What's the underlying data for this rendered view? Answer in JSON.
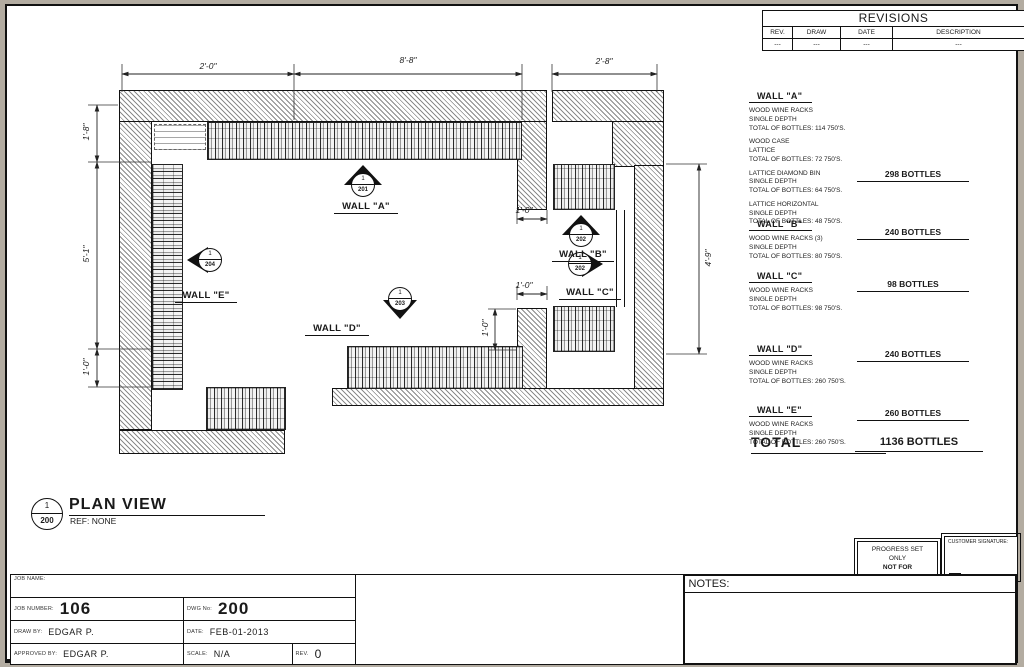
{
  "revisions": {
    "title": "REVISIONS",
    "columns": [
      "REV.",
      "DRAW",
      "DATE",
      "DESCRIPTION"
    ],
    "row": [
      "---",
      "---",
      "---",
      "---"
    ]
  },
  "plan": {
    "title": {
      "num": "1",
      "sheet": "200",
      "title": "PLAN VIEW",
      "ref": "REF: NONE"
    },
    "dims": {
      "top1": "2'-0\"",
      "top2": "8'-8\"",
      "top3": "2'-8\"",
      "left1": "1'-8\"",
      "left2": "5'-1\"",
      "left3": "1'-0\"",
      "right1": "4'-9\"",
      "inner_b": "1'-0\"",
      "inner_c": "1'-0\"",
      "inner_d": "1'-0\""
    },
    "markers": {
      "a": {
        "num": "1",
        "sheet": "201",
        "label": "WALL \"A\""
      },
      "b": {
        "num": "1",
        "sheet": "202",
        "label": "WALL \"B\""
      },
      "c": {
        "num": "1",
        "sheet": "202",
        "label": "WALL \"C\""
      },
      "d": {
        "num": "1",
        "sheet": "203",
        "label": "WALL \"D\""
      },
      "e": {
        "num": "1",
        "sheet": "204",
        "label": "WALL \"E\""
      }
    }
  },
  "specs": {
    "walls": [
      {
        "name": "WALL \"A\"",
        "items": [
          "WOOD WINE RACKS\nSINGLE DEPTH\nTOTAL OF BOTTLES: 114 750'S.",
          "WOOD CASE\nLATTICE\nTOTAL OF BOTTLES: 72 750'S.",
          "LATTICE DIAMOND BIN\nSINGLE DEPTH\nTOTAL OF BOTTLES: 64 750'S.",
          "LATTICE HORIZONTAL\nSINGLE DEPTH\nTOTAL OF BOTTLES: 48 750'S."
        ],
        "total": "298 BOTTLES"
      },
      {
        "name": "WALL \"B\"",
        "items": [
          "WOOD WINE RACKS (3)\nSINGLE DEPTH\nTOTAL OF BOTTLES: 80 750'S."
        ],
        "total": "240 BOTTLES"
      },
      {
        "name": "WALL \"C\"",
        "items": [
          "WOOD WINE RACKS\nSINGLE DEPTH\nTOTAL OF BOTTLES: 98 750'S."
        ],
        "total": "98 BOTTLES"
      },
      {
        "name": "WALL \"D\"",
        "items": [
          "WOOD WINE RACKS\nSINGLE DEPTH\nTOTAL OF BOTTLES: 260 750'S."
        ],
        "total": "240 BOTTLES"
      },
      {
        "name": "WALL \"E\"",
        "items": [
          "WOOD WINE RACKS\nSINGLE DEPTH\nTOTAL OF BOTTLES: 260 750'S."
        ],
        "total": "260 BOTTLES"
      }
    ],
    "total_label": "TOTAL",
    "total_value": "1136 BOTTLES"
  },
  "stamps": {
    "progress_line1": "PROGRESS SET",
    "progress_line2": "ONLY",
    "progress_line3": "NOT FOR CONSTRUCTION",
    "customer": "CUSTOMER SIGNATURE:"
  },
  "titleblock": {
    "job_name_label": "JOB NAME:",
    "job_number_label": "JOB NUMBER:",
    "job_number": "106",
    "dwg_label": "DWG No:",
    "dwg": "200",
    "drawn_label": "DRAW BY:",
    "drawn": "EDGAR P.",
    "date_label": "DATE:",
    "date": "FEB-01-2013",
    "approved_label": "APPROVED BY:",
    "approved": "EDGAR P.",
    "scale_label": "SCALE:",
    "scale": "N/A",
    "rev_label": "REV.",
    "rev": "0",
    "notes_label": "NOTES:"
  }
}
